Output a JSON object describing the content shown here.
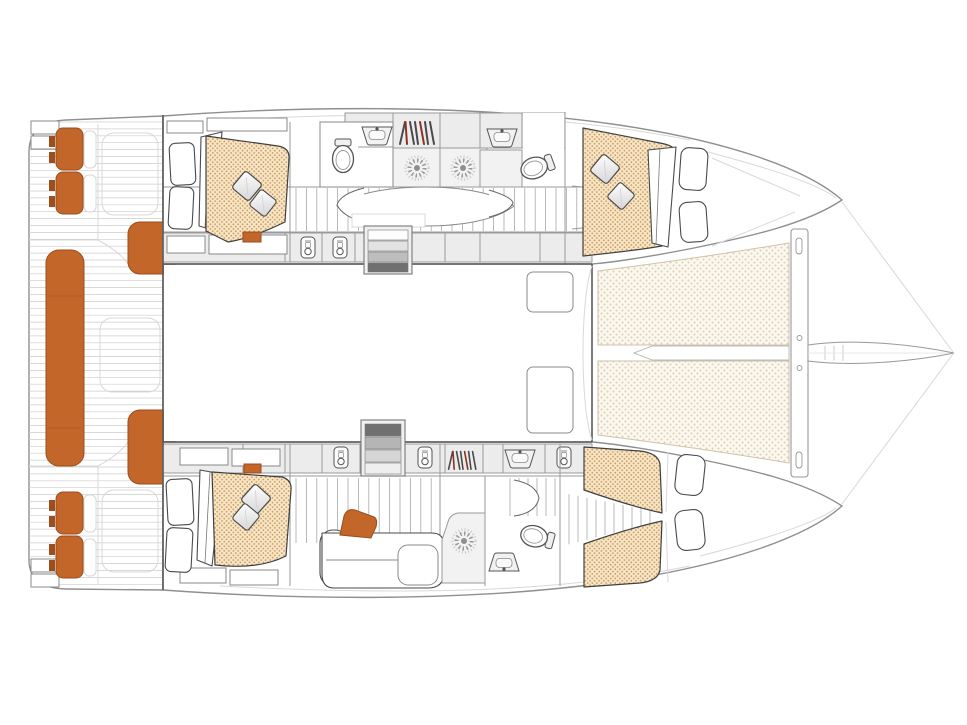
{
  "diagram": {
    "kind": "catamaran-interior-floor-plan",
    "orientation": "bow-right",
    "visible_text": [],
    "colors": {
      "background": "#ffffff",
      "hull-outline": "#8f8f8f",
      "furniture-outline": "#3f3f3f",
      "wall": "#9a9a9a",
      "faint": "#d8d8d8",
      "plank": "#cccccc",
      "cell-fill": "#ececec",
      "upholstery-orange": "#c2662a",
      "upholstery-orange-dark": "#9c4e1d",
      "mattress-base": "#f6e7ca",
      "mattress-dot": "#d09a58",
      "trampoline-base": "#fbf8f0",
      "trampoline-dot": "#ddcfae",
      "accent-red": "#8c3220",
      "step-dark": "#707070"
    },
    "features": {
      "cockpit": [
        "stern-platform-steps",
        "helm-seats-orange-cushions",
        "aft-bench-orange",
        "corner-seats-orange",
        "plank-deck"
      ],
      "port_hull": [
        "aft-double-berth",
        "aft-bathroom-toilet-sink",
        "hanging-locker",
        "shower-cells",
        "forward-bathroom",
        "forward-double-berth",
        "companionway"
      ],
      "starboard_hull": [
        "aft-double-berth",
        "lounge-sofa-orange-cushion",
        "shower-cell",
        "forward-bathroom",
        "v-berth-twin-beds",
        "companionway"
      ],
      "saloon": [
        "open-floor",
        "port-entry-stairs",
        "starboard-entry-stairs",
        "forward-hatches"
      ],
      "foredeck": [
        "trampoline-port",
        "trampoline-starboard",
        "center-walkway",
        "cross-beam",
        "bowsprit"
      ]
    }
  }
}
